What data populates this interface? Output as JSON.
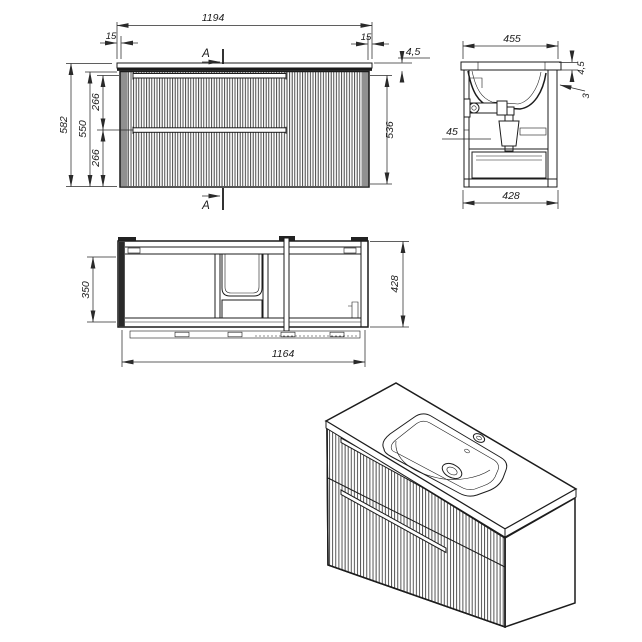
{
  "drawing": {
    "type": "bathroom vanity cabinet with washbasin - dimensioned orthographic views and 3D view",
    "colors": {
      "line": "#1c1c1c",
      "background": "#ffffff",
      "flute_band": "#909090"
    },
    "front_view": {
      "section_label": "A",
      "dims": {
        "countertop_width": "1194",
        "overhang_left": "15",
        "overhang_right": "15",
        "countertop_thickness": "4,5",
        "total_height": "582",
        "body_height": "550",
        "upper_drawer_height": "266",
        "lower_drawer_height": "266",
        "front_panel_height": "536"
      }
    },
    "side_view": {
      "dims": {
        "countertop_depth": "455",
        "countertop_edge_thickness": "4,5",
        "rim_step": "3",
        "service_gap": "45",
        "cabinet_depth": "428"
      }
    },
    "plan_view": {
      "dims": {
        "inner_depth": "350",
        "cabinet_depth": "428",
        "cabinet_width": "1164"
      }
    }
  }
}
